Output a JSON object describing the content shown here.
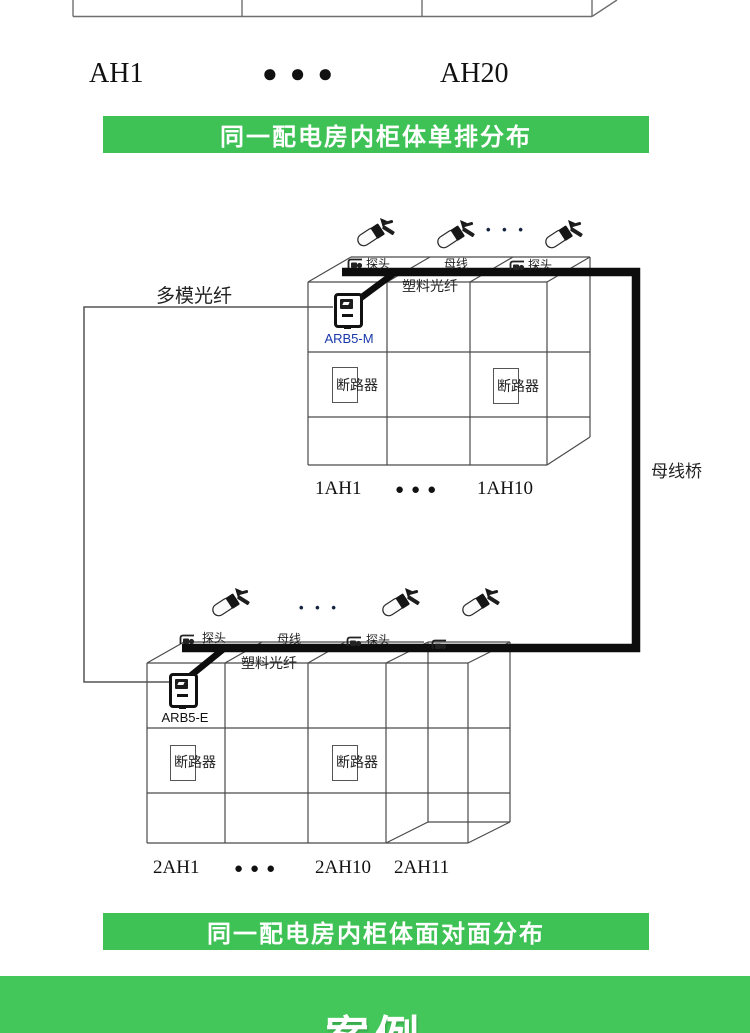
{
  "top_row": {
    "left": "AH1",
    "dots": "●●●",
    "right": "AH20"
  },
  "banners": {
    "first": "同一配电房内柜体单排分布",
    "second": "同一配电房内柜体面对面分布"
  },
  "diagram1": {
    "probe_label_1": "探头",
    "busbar_label": "母线",
    "probe_label_2": "探头",
    "sensor_ellipsis": "• • •",
    "plastic_fiber_label": "塑料光纤",
    "multimode_fiber_label": "多模光纤",
    "device_label": "ARB5-M",
    "breaker_label": "断路器",
    "cabinet_first": "1AH1",
    "cabinet_dots": "●●●",
    "cabinet_last": "1AH10",
    "bridge_label": "母线桥"
  },
  "diagram2": {
    "probe_label_1": "探头",
    "busbar_label": "母线",
    "probe_label_2": "探头",
    "sensor_ellipsis": "• • •",
    "plastic_fiber_label": "塑料光纤",
    "device_label": "ARB5-E",
    "breaker_label": "断路器",
    "cabinet_first": "2AH1",
    "cabinet_dots": "●●●",
    "cabinet_last": "2AH10",
    "cabinet_extra": "2AH11"
  },
  "bottom_section": {
    "title": "案例"
  },
  "colors": {
    "banner_green": "#3EC155",
    "bottom_green": "#44C75A",
    "busbar_black": "#0D0D0D",
    "cabinet_line_gray": "#4A4A4A",
    "device_m_label_blue": "#1A38A8"
  }
}
